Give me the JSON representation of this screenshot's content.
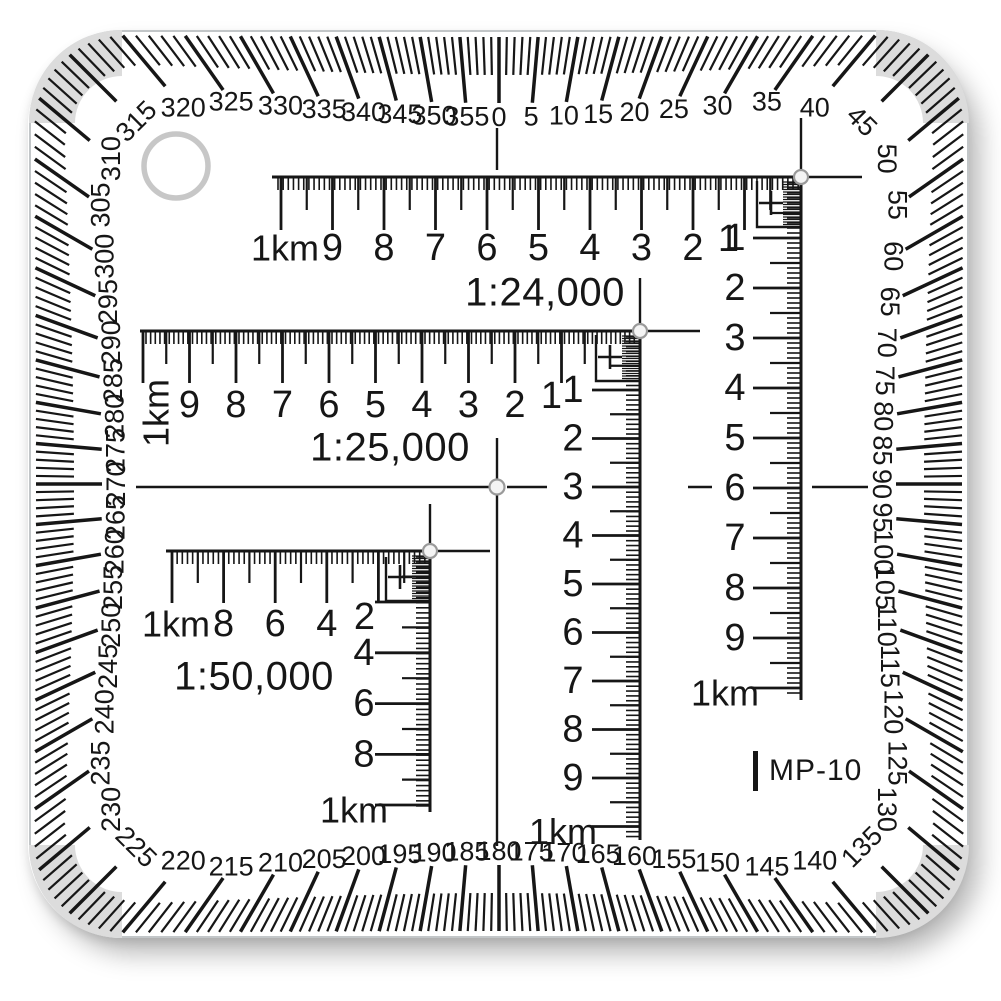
{
  "product": {
    "model_label": "MP-10"
  },
  "colors": {
    "ink": "#161616",
    "corner_band": "#dcdcdc",
    "ring": "#c7c7c7",
    "hole_fill": "#f4f4f4",
    "hole_stroke": "#9a9a9a",
    "plate_edge": "#c2c6c8"
  },
  "protractor": {
    "degree_labels": [
      "0",
      "5",
      "10",
      "15",
      "20",
      "25",
      "30",
      "35",
      "40",
      "45",
      "50",
      "55",
      "60",
      "65",
      "70",
      "75",
      "80",
      "85",
      "90",
      "95",
      "100",
      "105",
      "110",
      "115",
      "120",
      "125",
      "130",
      "135",
      "140",
      "145",
      "150",
      "155",
      "160",
      "165",
      "170",
      "175",
      "180",
      "185",
      "190",
      "195",
      "200",
      "205",
      "210",
      "215",
      "220",
      "225",
      "230",
      "235",
      "240",
      "245",
      "250",
      "255",
      "260",
      "265",
      "270",
      "275",
      "280",
      "285",
      "290",
      "295",
      "300",
      "305",
      "310",
      "315",
      "320",
      "325",
      "330",
      "335",
      "340",
      "345",
      "350",
      "355"
    ]
  },
  "rulers": [
    {
      "scale_label": "1:24,000",
      "h_unit_label": "1km",
      "h_numbers": [
        "9",
        "8",
        "7",
        "6",
        "5",
        "4",
        "3",
        "2",
        "1"
      ],
      "v_numbers": [
        "1",
        "2",
        "3",
        "4",
        "5",
        "6",
        "7",
        "8",
        "9"
      ],
      "v_unit_label": "1km"
    },
    {
      "scale_label": "1:25,000",
      "h_unit_label": "1km",
      "h_numbers": [
        "9",
        "8",
        "7",
        "6",
        "5",
        "4",
        "3",
        "2",
        "1"
      ],
      "v_numbers": [
        "1",
        "2",
        "3",
        "4",
        "5",
        "6",
        "7",
        "8",
        "9"
      ],
      "v_unit_label": "1km"
    },
    {
      "scale_label": "1:50,000",
      "h_unit_label": "1km",
      "h_numbers": [
        "8",
        "6",
        "4",
        "2"
      ],
      "v_numbers": [
        "4",
        "6",
        "8"
      ],
      "v_unit_label": "1km"
    }
  ]
}
